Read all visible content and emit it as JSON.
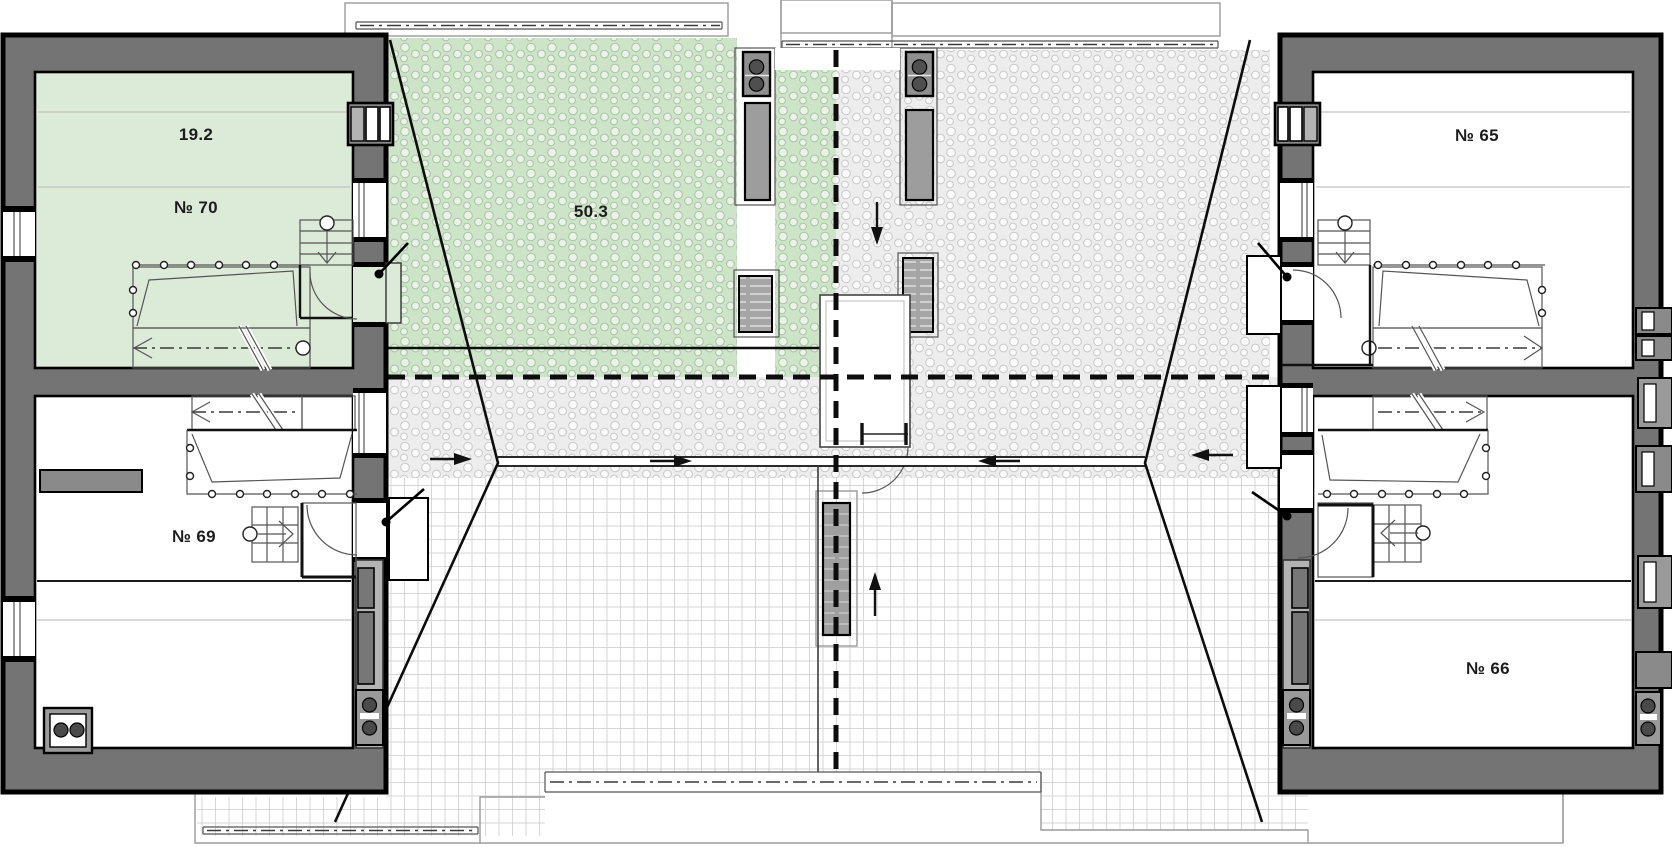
{
  "plan": {
    "title": "attic floor plan",
    "units": [
      {
        "id": "70",
        "number_label": "№ 70",
        "area_label": "19.2",
        "highlighted": true
      },
      {
        "id": "69",
        "number_label": "№ 69",
        "highlighted": false
      },
      {
        "id": "65",
        "number_label": "№ 65",
        "highlighted": false
      },
      {
        "id": "66",
        "number_label": "№ 66",
        "highlighted": false
      }
    ],
    "terrace": {
      "area_label": "50.3",
      "highlighted": true
    },
    "colors": {
      "highlight_room": "#dcead8",
      "highlight_hatch_bg": "#cde4c9",
      "wall_gray": "#747474",
      "wall_light": "#b3b3b3",
      "line_black": "#0d0d0d",
      "roof_gray_hatch_bg": "#ededed",
      "tile_line": "#d6d6d6"
    }
  }
}
